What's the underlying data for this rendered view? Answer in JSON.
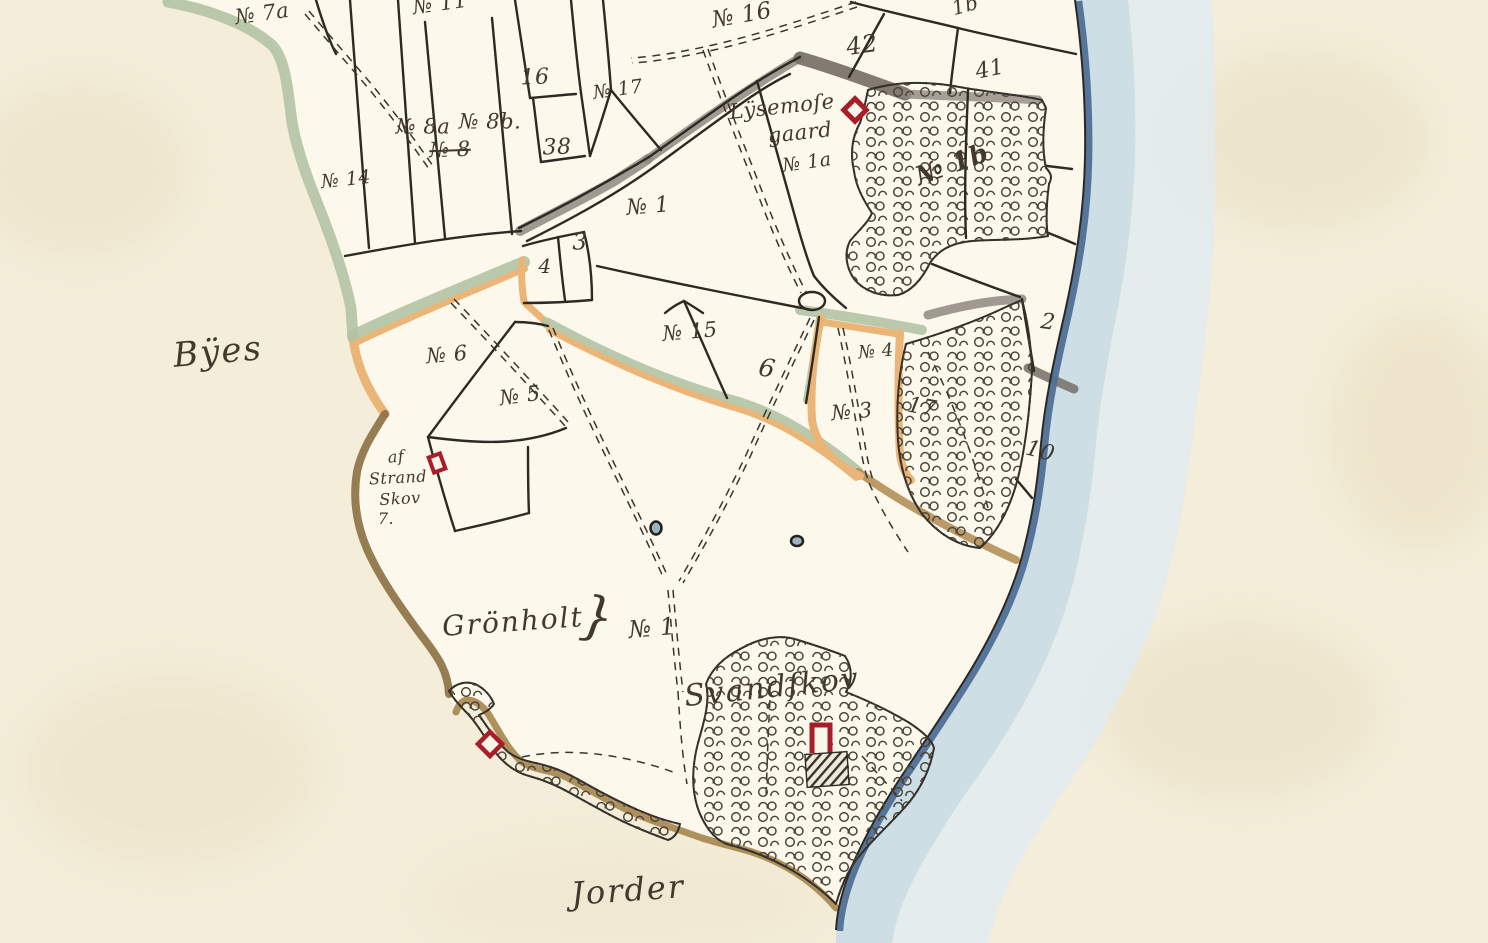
{
  "map": {
    "type": "historical cadastral map (hand-drawn, watercolour on paper)",
    "labels": {
      "byes": "Bÿes",
      "no7a": "№ 7a",
      "no11": "№ 11",
      "no16_top": "№ 16",
      "p1b_top": "1b",
      "p42": "42",
      "p41": "41",
      "no17": "№ 17",
      "p16": "16",
      "p38": "38",
      "no8a": "№ 8a",
      "no8b": "№ 8b.",
      "no8_struck": "№ 8",
      "no14": "№ 14",
      "lysemose_line1": "Lÿsemoſe",
      "lysemose_line2": "gaard",
      "no1a": "№ 1a",
      "no1b": "№ 1b",
      "p3": "3",
      "p4": "4",
      "no1_north": "№ 1",
      "no6": "№ 6",
      "no5": "№ 5",
      "no15": "№ 15",
      "p6": "6",
      "no4": "№ 4",
      "no3": "№ 3",
      "p2": "2",
      "p17": "17",
      "p10": "10",
      "strand_line1": "af",
      "strand_line2": "Strand",
      "strand_line3": "Skov",
      "strand_line4": "7.",
      "gronholt": "Grönholt",
      "gronholt_brace": "}",
      "no1_south": "№ 1",
      "svandskov": "Svandſkov",
      "jorder": "Jorder"
    },
    "colors": {
      "paper": "#f3edd9",
      "land": "#fcf8eb",
      "sea_wash_inner": "#c7dbe6",
      "sea_wash_outer": "#e0ebf1",
      "coast_blue": "#4e7096",
      "boundary_green": "#b2c2a4",
      "boundary_orange": "#eab577",
      "boundary_brown": "#8e7245",
      "road_gray": "#8f8882",
      "ink": "#2e2923",
      "building_red": "#a81e28"
    }
  }
}
